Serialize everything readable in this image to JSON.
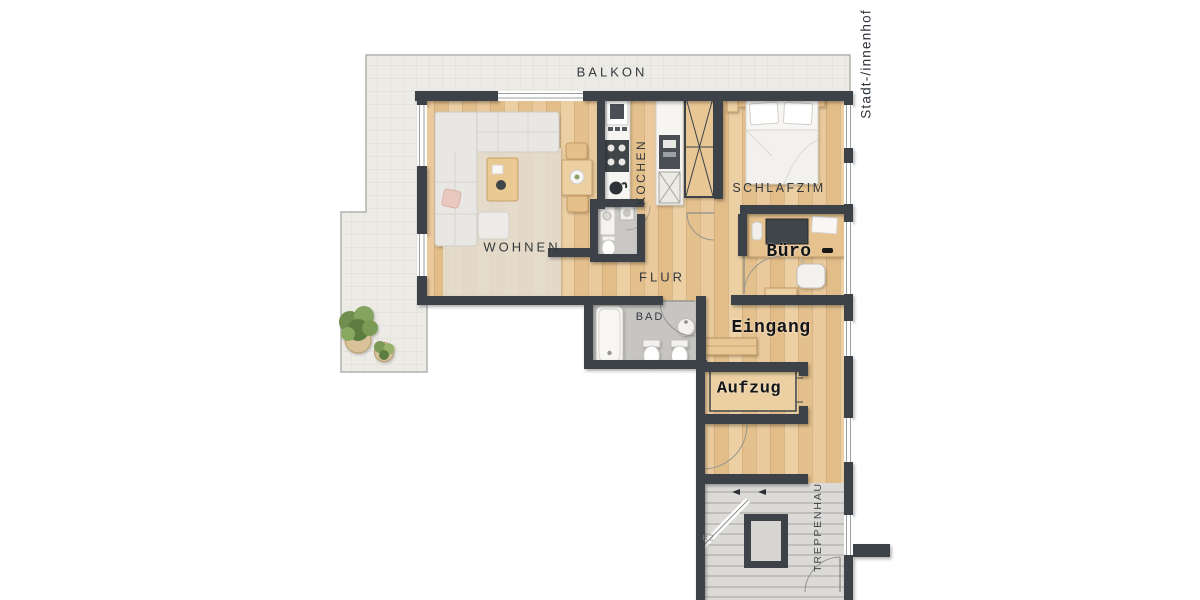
{
  "floorplan": {
    "rooms": {
      "balkon": "BALKON",
      "wohnen": "WOHNEN",
      "kochen": "KOCHEN",
      "schlafzimmer": "SCHLAFZIM",
      "flur": "FLUR",
      "bad": "BAD",
      "buero": "Büro",
      "eingang": "Eingang",
      "aufzug": "Aufzug",
      "treppenhaus": "TREPPENHAU"
    },
    "annotations": {
      "orientation_label": "Stadt-/innenhof",
      "stair_dimension": "8.2"
    },
    "colors": {
      "wall": "#3d4249",
      "wood_floor": "#e8c795",
      "balcony_tile": "#edebe6",
      "bath_floor": "#c6c5c2",
      "stair_floor": "#dbdad7",
      "furniture_white": "#f7f6f4",
      "furniture_wood": "#e6c28f",
      "label_text": "#33383d",
      "stamp_text": "#141518"
    }
  }
}
